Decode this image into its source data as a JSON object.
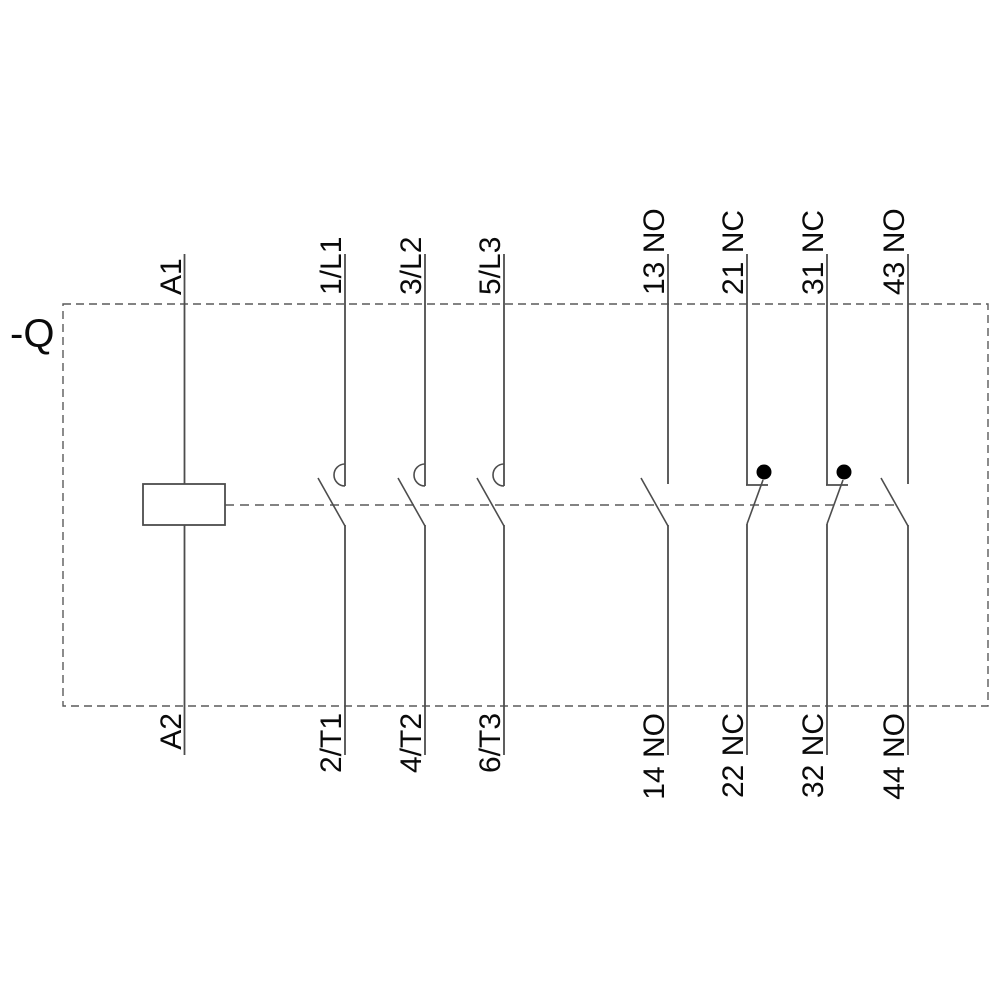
{
  "device": {
    "designation": "-Q"
  },
  "coil": {
    "top_terminal": "A1",
    "bottom_terminal": "A2"
  },
  "poles": [
    {
      "contact": "main-power-no",
      "symbol": "breaker-arc-contact",
      "top_terminal": "1/L1",
      "bottom_terminal": "2/T1"
    },
    {
      "contact": "main-power-no",
      "symbol": "breaker-arc-contact",
      "top_terminal": "3/L2",
      "bottom_terminal": "4/T2"
    },
    {
      "contact": "main-power-no",
      "symbol": "breaker-arc-contact",
      "top_terminal": "5/L3",
      "bottom_terminal": "6/T3"
    },
    {
      "contact": "aux-normally-open",
      "symbol": "no-contact",
      "top_terminal": "13 NO",
      "bottom_terminal": "14 NO"
    },
    {
      "contact": "aux-normally-closed",
      "symbol": "nc-contact-dot",
      "top_terminal": "21 NC",
      "bottom_terminal": "22 NC"
    },
    {
      "contact": "aux-normally-closed",
      "symbol": "nc-contact-dot",
      "top_terminal": "31 NC",
      "bottom_terminal": "32 NC"
    },
    {
      "contact": "aux-normally-open",
      "symbol": "no-contact",
      "top_terminal": "43 NO",
      "bottom_terminal": "44 NO"
    }
  ],
  "colors": {
    "background": "#ffffff",
    "line": "#4d4d4d",
    "dashed_line": "#5a5a5a",
    "text": "#0a0a0a",
    "nc_dot": "#000000"
  }
}
